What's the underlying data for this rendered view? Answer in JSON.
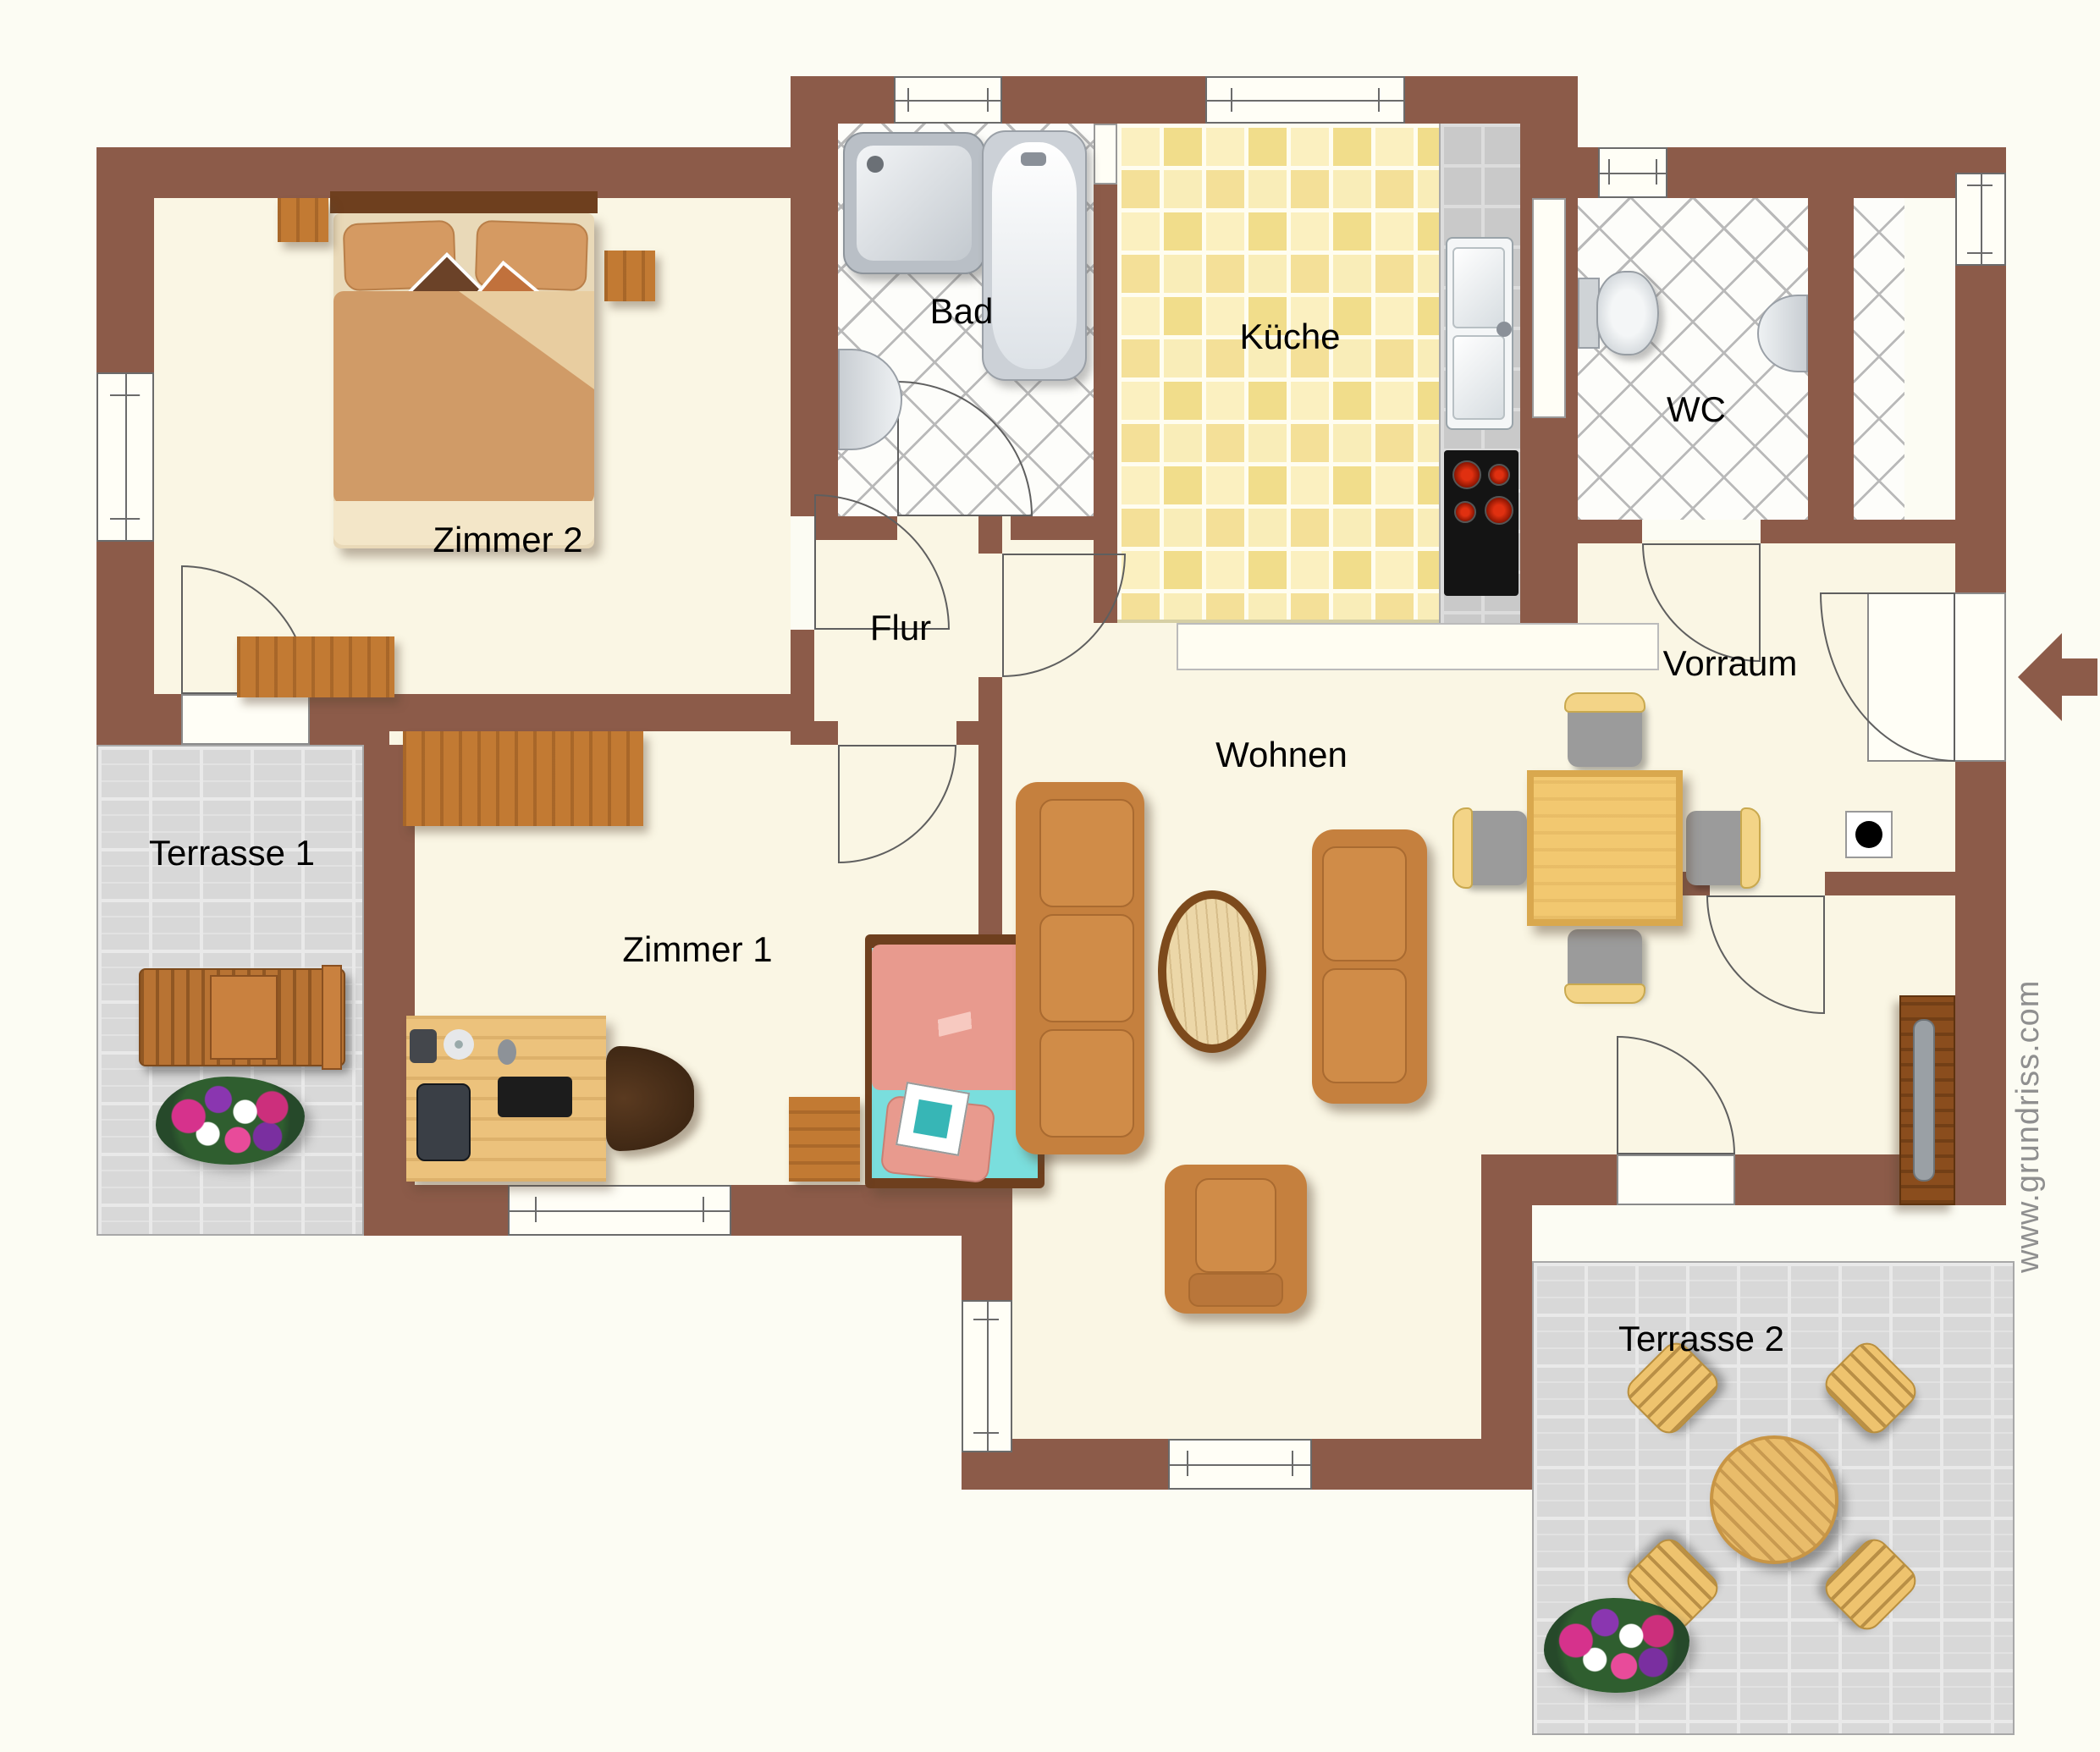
{
  "rooms": {
    "zimmer2": {
      "label": "Zimmer 2"
    },
    "bad": {
      "label": "Bad"
    },
    "kueche": {
      "label": "Küche"
    },
    "wc": {
      "label": "WC"
    },
    "vorraum": {
      "label": "Vorraum"
    },
    "flur": {
      "label": "Flur"
    },
    "zimmer1": {
      "label": "Zimmer 1"
    },
    "wohnen": {
      "label": "Wohnen"
    },
    "terrasse1": {
      "label": "Terrasse 1"
    },
    "terrasse2": {
      "label": "Terrasse 2"
    }
  },
  "watermark": "www.grundriss.com",
  "colors": {
    "wall": "#8c5b49",
    "floor": "#faf6e4",
    "kitchen_tile": "#f6e59d",
    "bath_tile_line": "#b9b9b9",
    "terrace_tile": "#d8d8d8",
    "entrance_arrow": "#8c5b49",
    "bed1_duvet": "#e89a8e",
    "bed1_sheet": "#7adedd",
    "bed2_duvet": "#d09b67",
    "sofa": "#c5803e",
    "stove_burner": "#cc2200"
  },
  "icons": {
    "entrance-arrow": "left-pointing entry arrow",
    "double-bed": "double bed with pillows",
    "single-bed": "single bed pink/turquoise",
    "wardrobe": "wood wardrobe",
    "sideboard": "wood sideboard",
    "desk-computer": "desk with monitor, keyboard, speaker, disc, mouse",
    "office-chair": "swivel chair",
    "sofa-3seat": "three-seat sofa",
    "sofa-2seat": "two-seat sofa",
    "coffee-table-oval": "oval wood coffee table",
    "armchair": "armchair",
    "dining-table": "square dining table",
    "dining-chair": "dining chair",
    "tv-board": "tv lowboard",
    "kitchen-counter": "counter with double sink",
    "stove": "cooktop with 4 burners",
    "shower": "square shower tray",
    "bathtub": "bathtub",
    "wash-basin": "wash basin",
    "toilet": "toilet",
    "utility-box": "connection point (black dot)",
    "sun-lounger": "wooden sun lounger",
    "flower-bed": "flower patch",
    "terrace-table-round": "round terrace table"
  }
}
